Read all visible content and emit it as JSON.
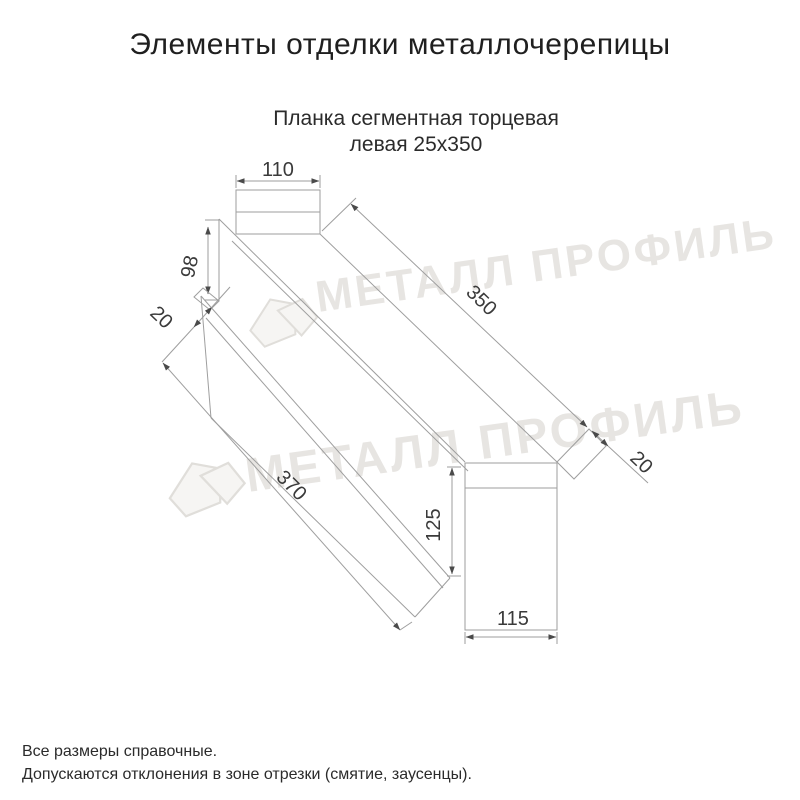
{
  "title": "Элементы отделки металлочерепицы",
  "subtitle": {
    "line1": "Планка сегментная торцевая",
    "line2": "левая 25х350"
  },
  "watermark": {
    "text": "МЕТАЛЛ ПРОФИЛЬ"
  },
  "dimensions": {
    "top_width": "110",
    "left_height": "98",
    "left_fold": "20",
    "top_length": "350",
    "right_fold": "20",
    "bottom_length": "370",
    "end_height": "125",
    "end_width": "115"
  },
  "footnotes": [
    "Все размеры справочные.",
    "Допускаются отклонения в зоне отрезки (смятие, заусенцы)."
  ],
  "colors": {
    "line": "#9e9e9e",
    "title_text": "#1f1f1f",
    "dim_text": "#3a3a3a",
    "watermark": "#e7e5e2",
    "background": "#ffffff"
  }
}
